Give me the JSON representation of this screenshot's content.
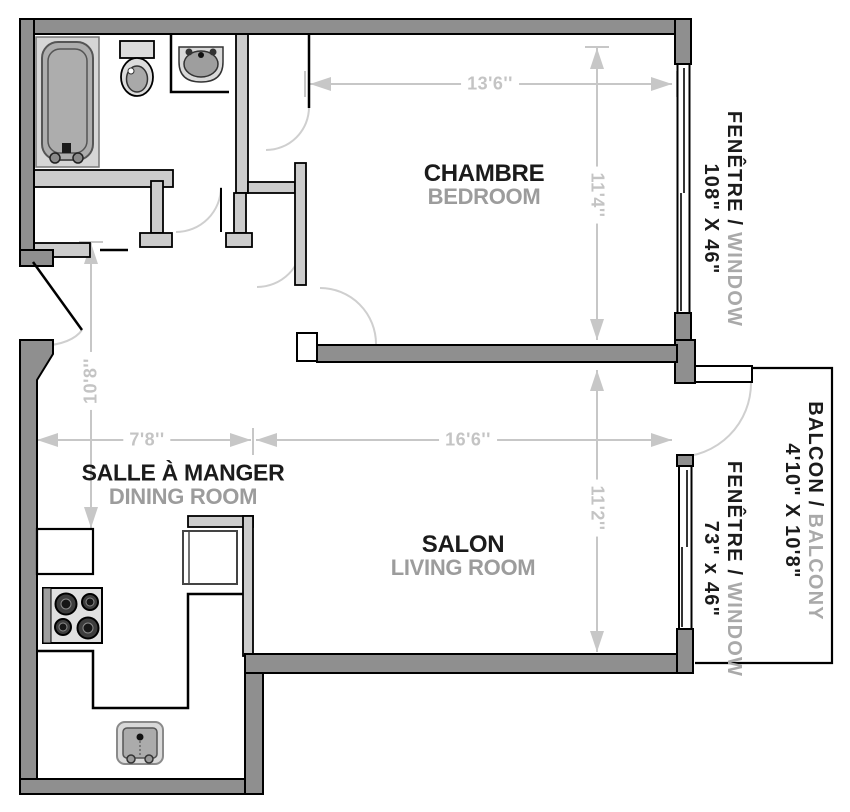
{
  "rooms": {
    "bedroom": {
      "fr": "CHAMBRE",
      "en": "BEDROOM"
    },
    "living_room": {
      "fr": "SALON",
      "en": "LIVING ROOM"
    },
    "dining_room": {
      "fr": "SALLE À MANGER",
      "en": "DINING ROOM"
    }
  },
  "dimensions": {
    "bedroom_width": "13'6''",
    "bedroom_depth": "11'4''",
    "entry_wall": "10'8''",
    "dining_width": "7'8''",
    "living_width": "16'6''",
    "living_depth": "11'2''"
  },
  "side_labels": {
    "bedroom_window": {
      "fr": "FENÊTRE /",
      "en": "WINDOW",
      "size": "108\" X 46\""
    },
    "balcony": {
      "fr": "BALCON /",
      "en": "BALCONY",
      "size": "4'10\" X 10'8\""
    },
    "living_window": {
      "fr": "FENÊTRE /",
      "en": "WINDOW",
      "size": "73\" x 46\""
    }
  },
  "fixtures": [
    "bathtub",
    "toilet",
    "bathroom-sink",
    "stove",
    "refrigerator",
    "kitchen-sink"
  ],
  "colors": {
    "outer_wall": "#8f8f8f",
    "interior_wall": "#cccccc",
    "outline": "#000000",
    "dimension": "#c7c7c7",
    "door_swing": "#cfcfcf",
    "label_primary": "#1b1b1b",
    "label_secondary": "#9c9c9c",
    "background": "#ffffff"
  }
}
